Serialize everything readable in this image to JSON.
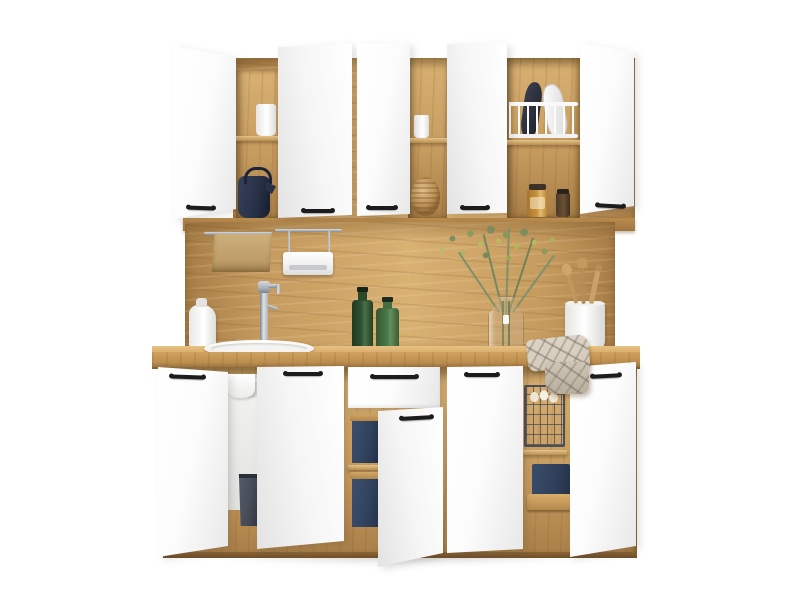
{
  "image": {
    "type": "product-photo",
    "subject": "White and oak modular kitchen cabinet set with open doors, styled with dishes and plants"
  },
  "palette": {
    "oak-light": "#d9b173",
    "oak-mid": "#c59a5e",
    "oak-dark": "#a87e47",
    "oak-deep": "#8f6838",
    "counter-top": "#d9ad6a",
    "counter-front": "#bc8e4f",
    "door-white": "#fcfcfc",
    "door-shade": "#e8e8e8",
    "handle-black": "#1c1c1c",
    "kettle-navy": "#273046",
    "bin-slate": "#454b57",
    "crate-navy": "#30415c",
    "bottle-green-dark": "#2f5133",
    "bottle-green-light": "#4b7a4a",
    "foliage-olive": "#7b8d60",
    "foliage-bud": "#b5bf5e",
    "towel-tan": "#bd9c68",
    "plaid-base": "#d3c9ba",
    "plaid-line": "#8f877a",
    "chrome": "#aeb4bb",
    "chrome-dark": "#7c838c",
    "egg-cream": "#efe6d7",
    "jar-amber": "#c68f3e"
  },
  "structure": {
    "wall-units": "three white wall cabinets with five doors, several open",
    "backsplash": "oak panel with hanging rails",
    "worktop": "oak countertop with round white sink",
    "base-units": "white base cabinets with drawer, doors open showing oak interiors",
    "plinth": "oak plinth"
  },
  "props": {
    "mug": "white mug on shelf",
    "kettle": "dark navy kettle",
    "white-pot": "white cup",
    "woven-basket": "round woven rattan basket",
    "dish-rack": "white dish drying rack with plates",
    "jars": "glass storage jars",
    "hanging-towel": "beige towel on chrome rail",
    "rail-shelf": "white shelf hanging on chrome rail",
    "soap-dispenser": "white soap dispenser",
    "faucet": "chrome kitchen faucet",
    "sink": "round white inset sink",
    "green-bottles": "two green glass bottles",
    "vase": "glass vase with yellow-green greenery",
    "utensil-crock": "white crock with wooden utensils",
    "plaid-towel": "checked kitchen towel on worktop edge",
    "sink-interior": "open sink cabinet with basin and waste bin",
    "trash-bin": "dark waste bin",
    "navy-crates": "navy storage boxes with wooden lids",
    "wire-basket": "black wire basket with eggs",
    "wood-tray": "wooden tray with navy fabric basket"
  }
}
